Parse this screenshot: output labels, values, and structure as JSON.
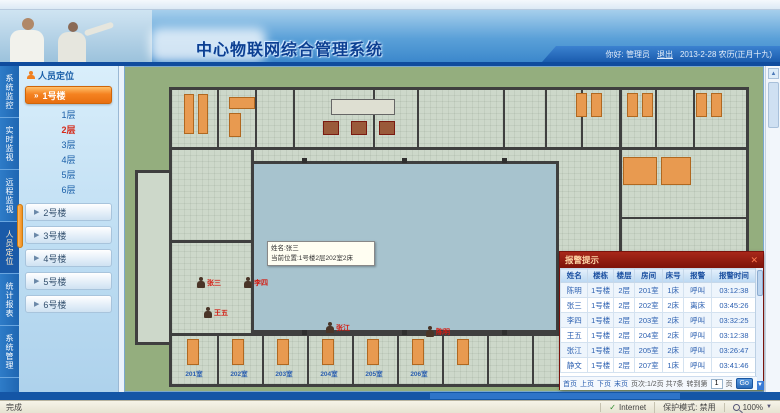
{
  "header": {
    "title_visible": "中心物联网综合管理系统",
    "greeting": "你好: 管理员",
    "logout": "退出",
    "date": "2013-2-28 农历(正月十九)"
  },
  "sidebar": {
    "panel_title": "人员定位",
    "tabs": [
      {
        "label": "系统监控"
      },
      {
        "label": "实时监视"
      },
      {
        "label": "远程监视"
      },
      {
        "label": "人员定位"
      },
      {
        "label": "统计报表"
      },
      {
        "label": "系统管理"
      }
    ],
    "active_building": "1号楼",
    "floors": [
      "1层",
      "2层",
      "3层",
      "4层",
      "5层",
      "6层"
    ],
    "active_floor": "2层",
    "buildings": [
      "2号楼",
      "3号楼",
      "4号楼",
      "5号楼",
      "6号楼"
    ]
  },
  "map": {
    "tooltip": {
      "line1": "姓名:张三",
      "line2": "当前位置:1号楼2层202室2床"
    },
    "markers": [
      {
        "name": "张三"
      },
      {
        "name": "李四"
      },
      {
        "name": "王五"
      },
      {
        "name": "张江"
      },
      {
        "name": "陈明"
      }
    ],
    "room_labels": [
      "201室",
      "202室",
      "203室",
      "204室",
      "205室",
      "206室"
    ]
  },
  "alarm": {
    "title": "报警提示",
    "close": "✕",
    "columns": [
      "姓名",
      "楼栋",
      "楼层",
      "房间",
      "床号",
      "报警",
      "报警时间"
    ],
    "rows": [
      [
        "陈明",
        "1号楼",
        "2层",
        "201室",
        "1床",
        "呼叫",
        "03:12:38"
      ],
      [
        "张三",
        "1号楼",
        "2层",
        "202室",
        "2床",
        "离床",
        "03:45:26"
      ],
      [
        "李四",
        "1号楼",
        "2层",
        "203室",
        "2床",
        "呼叫",
        "03:32:25"
      ],
      [
        "王五",
        "1号楼",
        "2层",
        "204室",
        "2床",
        "呼叫",
        "03:12:38"
      ],
      [
        "张江",
        "1号楼",
        "2层",
        "205室",
        "2床",
        "呼叫",
        "03:26:47"
      ],
      [
        "静文",
        "1号楼",
        "2层",
        "207室",
        "1床",
        "呼叫",
        "03:41:46"
      ]
    ],
    "pagination": {
      "first": "首页",
      "prev": "上页",
      "next": "下页",
      "last": "末页",
      "info": "页次:1/2页 共7条",
      "goto_label": "转到第",
      "goto_value": "1",
      "goto_suffix": "页",
      "go": "Go"
    }
  },
  "statusbar": {
    "left": "完成",
    "zone": "Internet",
    "protected_mode": "保护模式: 禁用",
    "zoom": "100%"
  },
  "colors": {
    "accent_orange": "#f58220",
    "header_blue": "#1e63b0",
    "alarm_red": "#8b1510",
    "active_floor_red": "#d42a1a"
  }
}
